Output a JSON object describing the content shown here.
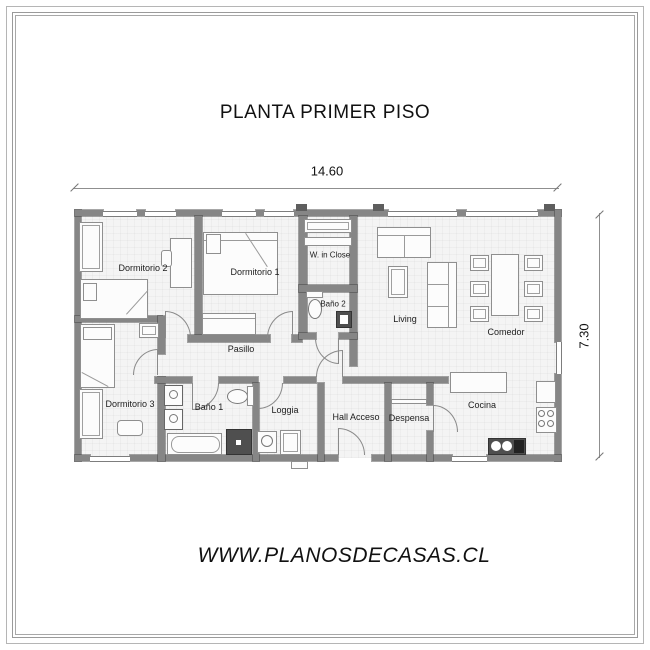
{
  "title": "PLANTA PRIMER PISO",
  "dimensions": {
    "width": "14.60",
    "height": "7.30"
  },
  "rooms": {
    "dormitorio1": "Dormitorio 1",
    "dormitorio2": "Dormitorio 2",
    "dormitorio3": "Dormitorio 3",
    "bano1": "Baño 1",
    "bano2": "Baño 2",
    "walk_in_closet": "W. in Close",
    "pasillo": "Pasillo",
    "living": "Living",
    "comedor": "Comedor",
    "cocina": "Cocina",
    "loggia": "Loggia",
    "hall_acceso": "Hall Acceso",
    "despensa": "Despensa"
  },
  "footer": {
    "website": "WWW.PLANOSDECASAS.CL"
  },
  "colors": {
    "wall": "#868686",
    "wall_dark": "#5e5e5e",
    "floor": "#f4f4f4",
    "outline": "#8f8f8f",
    "text": "#1c1c1c"
  }
}
